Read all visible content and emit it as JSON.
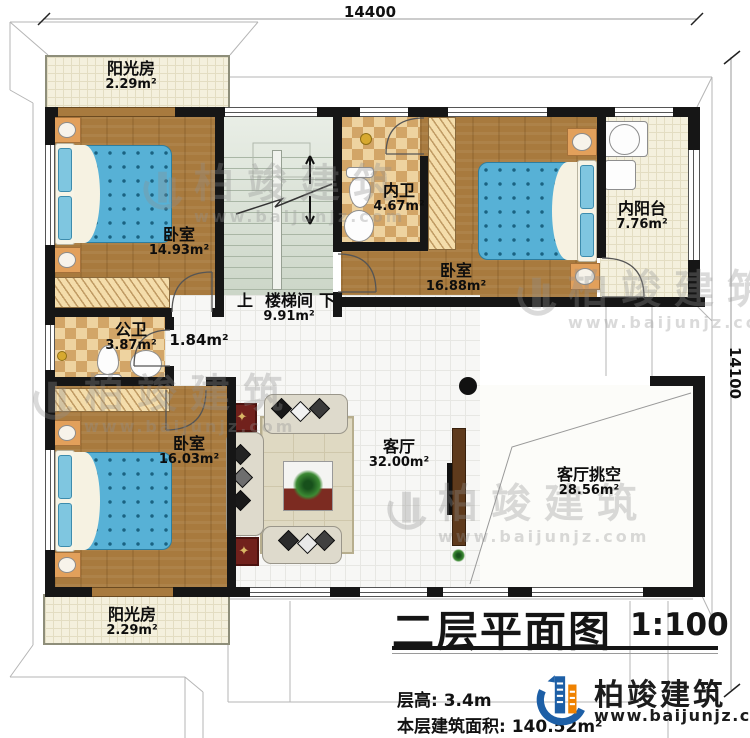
{
  "plan": {
    "dim_top": "14400",
    "dim_right": "14100",
    "rooms": {
      "sunroom_top": {
        "name": "阳光房",
        "area": "2.29m²"
      },
      "bedroom_tl": {
        "name": "卧室",
        "area": "14.93m²"
      },
      "stairwell": {
        "up": "上",
        "name": "楼梯间",
        "down": "下",
        "area": "9.91m²"
      },
      "bath_inner": {
        "name": "内卫",
        "area": "4.67m²"
      },
      "bedroom_tr": {
        "name": "卧室",
        "area": "16.88m²"
      },
      "balcony_inner": {
        "name": "内阳台",
        "area": "7.76m²"
      },
      "bath_public": {
        "name": "公卫",
        "area": "3.87m²"
      },
      "hallway": {
        "area": "1.84m²"
      },
      "bedroom_bl": {
        "name": "卧室",
        "area": "16.03m²"
      },
      "living_room": {
        "name": "客厅",
        "area": "32.00m²"
      },
      "living_void": {
        "name": "客厅挑空",
        "area": "28.56m²"
      },
      "sunroom_bottom": {
        "name": "阳光房",
        "area": "2.29m²"
      }
    }
  },
  "titleblock": {
    "title": "二层平面图",
    "scale": "1:100",
    "floor_height": "层高: 3.4m",
    "floor_area": "本层建筑面积: 140.52m²"
  },
  "brand": {
    "name": "柏竣建筑",
    "url": "www.baijunjz.com",
    "blue": "#1d5fa6",
    "orange": "#ef8200"
  }
}
